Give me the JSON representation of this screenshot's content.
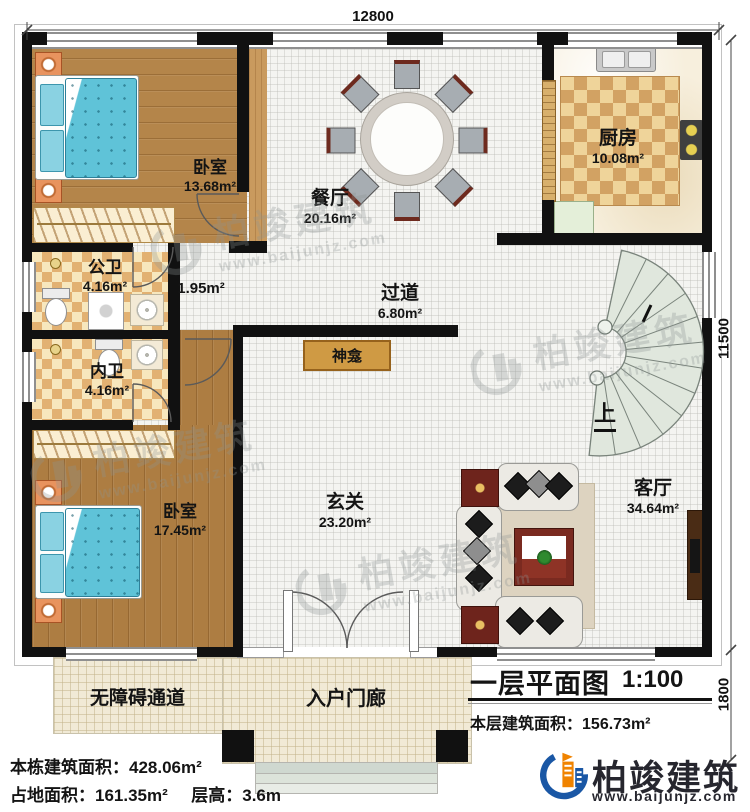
{
  "title_block": {
    "title": "一层平面图",
    "scale": "1:100",
    "floor_area_label": "本层建筑面积：",
    "floor_area_value": "156.73m²"
  },
  "dimensions": {
    "top": "12800",
    "right": "11500",
    "porch": "1800"
  },
  "rooms": {
    "bedroom1": {
      "name": "卧室",
      "area": "13.68m²"
    },
    "dining": {
      "name": "餐厅",
      "area": "20.16m²"
    },
    "kitchen": {
      "name": "厨房",
      "area": "10.08m²"
    },
    "public_bath": {
      "name": "公卫",
      "area": "4.16m²"
    },
    "small_hall": {
      "area": "1.95m²"
    },
    "corridor": {
      "name": "过道",
      "area": "6.80m²"
    },
    "ensuite_bath": {
      "name": "内卫",
      "area": "4.16m²"
    },
    "bedroom2": {
      "name": "卧室",
      "area": "17.45m²"
    },
    "entry_hall": {
      "name": "玄关",
      "area": "23.20m²"
    },
    "living": {
      "name": "客厅",
      "area": "34.64m²"
    },
    "shrine": {
      "name": "神龛"
    },
    "ramp": {
      "name": "无障碍通道"
    },
    "porch": {
      "name": "入户门廊"
    }
  },
  "stairs": {
    "direction_label": "上"
  },
  "footer": {
    "building_area_label": "本栋建筑面积：",
    "building_area_value": "428.06m²",
    "land_area_label": "占地面积：",
    "land_area_value": "161.35m²",
    "floor_height_label": "层高：",
    "floor_height_value": "3.6m"
  },
  "brand": {
    "name": "柏竣建筑",
    "website": "www.baijunjz.com",
    "blue": "#1a57a5",
    "orange": "#f08300"
  },
  "watermark": {
    "name": "柏竣建筑",
    "website": "www.baijunjz.com"
  }
}
